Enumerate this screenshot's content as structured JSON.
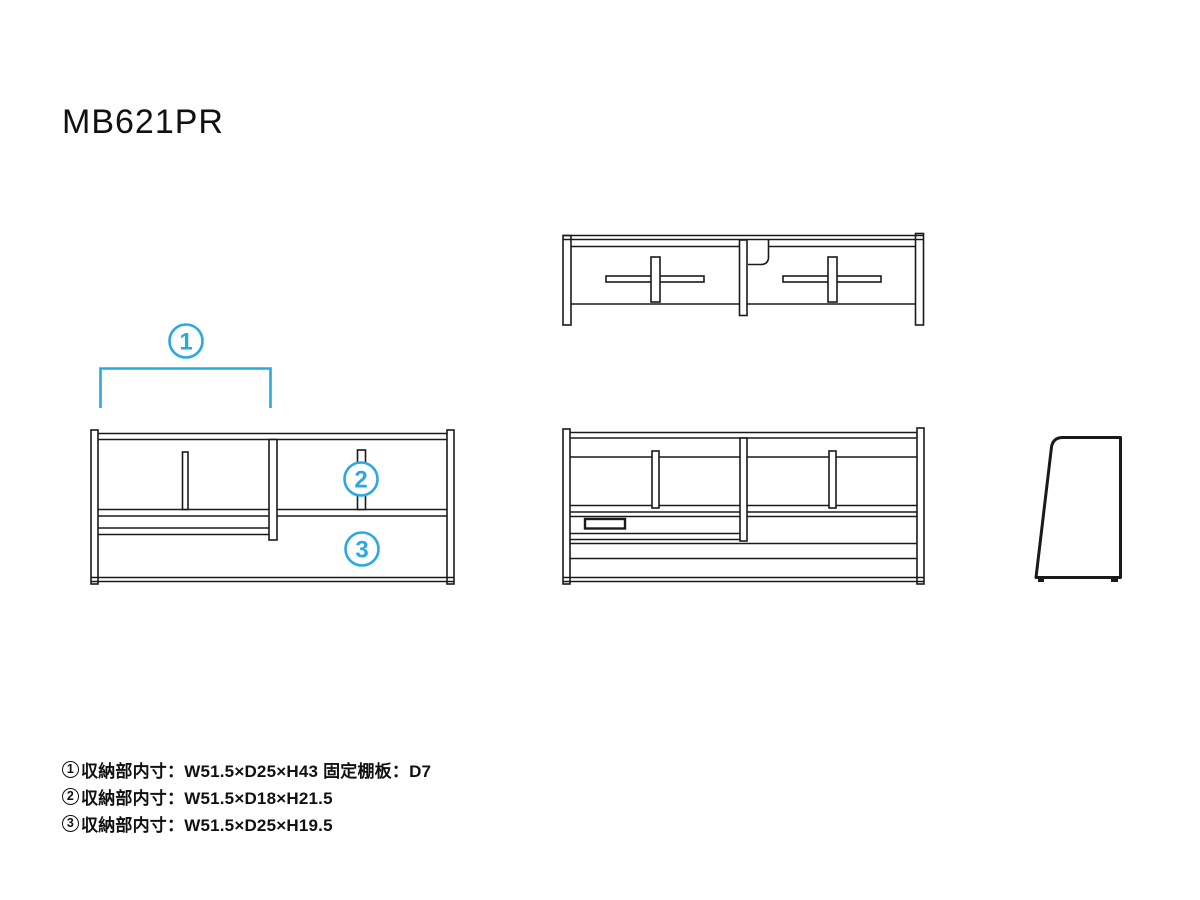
{
  "title": "MB621PR",
  "colors": {
    "line": "#1a1a1a",
    "accent": "#29a9e1",
    "background": "#ffffff"
  },
  "callouts": {
    "c1": "1",
    "c2": "2",
    "c3": "3"
  },
  "notes": [
    {
      "num": "1",
      "text": "収納部内寸：W51.5×D25×H43 固定棚板：D7"
    },
    {
      "num": "2",
      "text": "収納部内寸：W51.5×D18×H21.5"
    },
    {
      "num": "3",
      "text": "収納部内寸：W51.5×D25×H19.5"
    }
  ],
  "dimensions": [
    {
      "compartment": "1",
      "label": "収納部内寸",
      "width": "W51.5",
      "depth": "D25",
      "height": "H43",
      "fixed_shelf": "固定棚板：D7"
    },
    {
      "compartment": "2",
      "label": "収納部内寸",
      "width": "W51.5",
      "depth": "D18",
      "height": "H21.5"
    },
    {
      "compartment": "3",
      "label": "収納部内寸",
      "width": "W51.5",
      "depth": "D25",
      "height": "H19.5"
    }
  ]
}
